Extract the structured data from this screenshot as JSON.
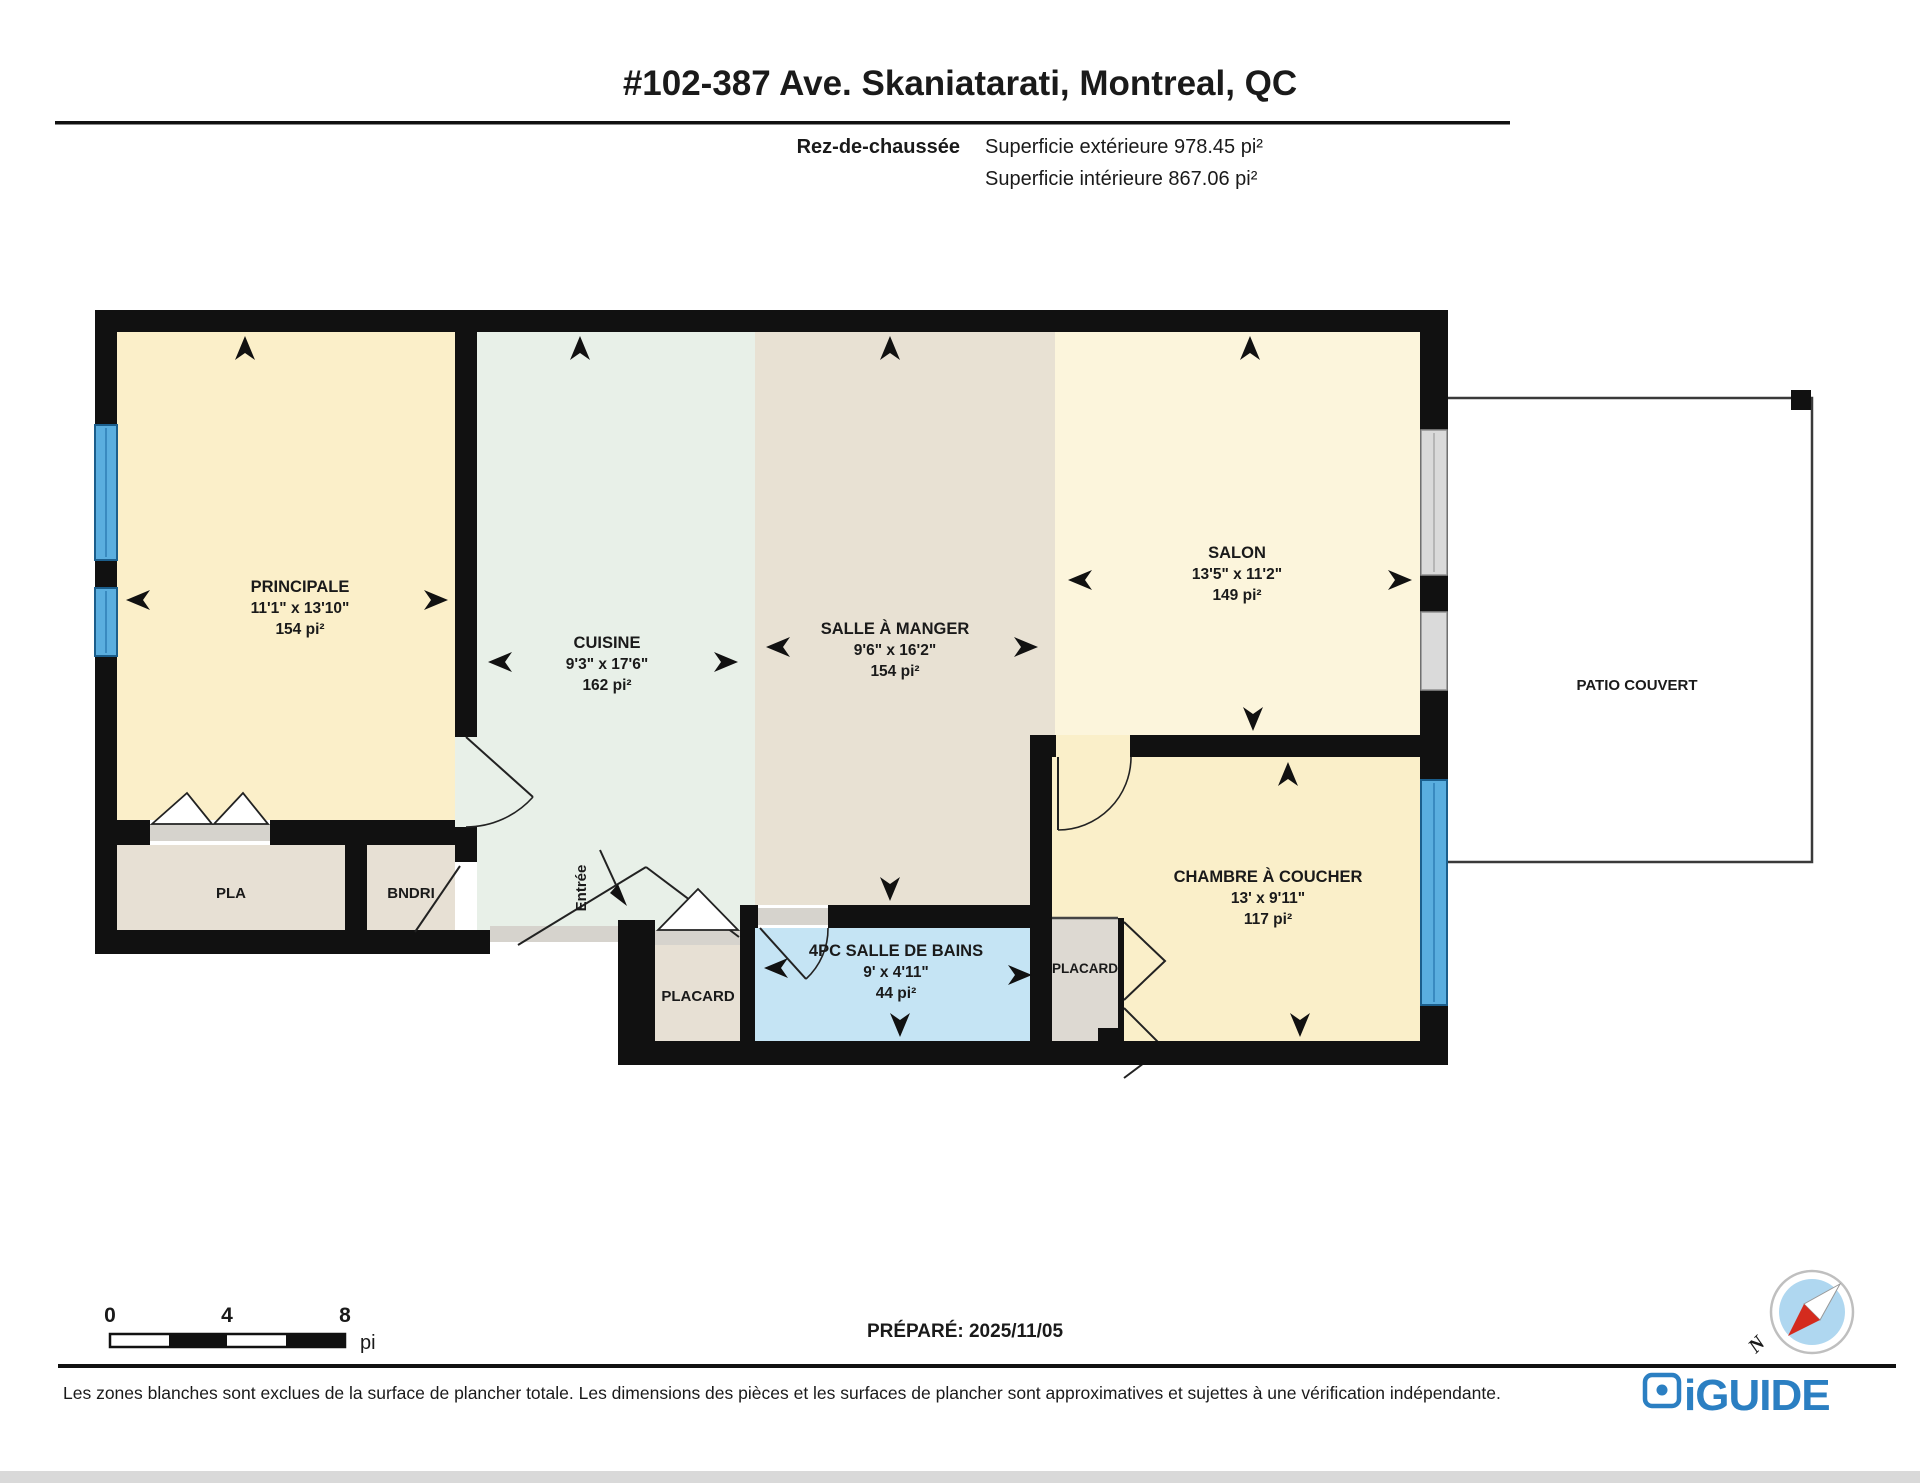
{
  "header": {
    "title": "#102-387 Ave. Skaniatarati, Montreal, QC",
    "floor_label": "Rez-de-chaussée",
    "exterior_area": "Superficie extérieure 978.45 pi²",
    "interior_area": "Superficie intérieure 867.06 pi²"
  },
  "rooms": {
    "principale": {
      "name": "PRINCIPALE",
      "dims": "11'1\" x 13'10\"",
      "area": "154 pi²"
    },
    "cuisine": {
      "name": "CUISINE",
      "dims": "9'3\" x 17'6\"",
      "area": "162 pi²"
    },
    "salle_a_manger": {
      "name": "SALLE À MANGER",
      "dims": "9'6\" x 16'2\"",
      "area": "154 pi²"
    },
    "salon": {
      "name": "SALON",
      "dims": "13'5\" x 11'2\"",
      "area": "149 pi²"
    },
    "chambre": {
      "name": "CHAMBRE À COUCHER",
      "dims": "13' x 9'11\"",
      "area": "117 pi²"
    },
    "salle_de_bains": {
      "name": "4PC SALLE DE BAINS",
      "dims": "9' x 4'11\"",
      "area": "44 pi²"
    },
    "pla": {
      "name": "PLA"
    },
    "bndri": {
      "name": "BNDRI"
    },
    "placard_1": {
      "name": "PLACARD"
    },
    "placard_2": {
      "name": "PLACARD"
    },
    "patio": {
      "name": "PATIO COUVERT"
    },
    "entree": {
      "name": "Entrée"
    }
  },
  "scale_bar": {
    "t0": "0",
    "t4": "4",
    "t8": "8",
    "unit": "pi"
  },
  "footer": {
    "prepared": "PRÉPARÉ: 2025/11/05",
    "disclaimer": "Les zones blanches sont exclues de la surface de plancher totale. Les dimensions des pièces et les surfaces de plancher sont approximatives et sujettes à une vérification indépendante.",
    "brand": "iGUIDE"
  },
  "compass": {
    "north": "N"
  },
  "colors": {
    "principale": "#FBEFC9",
    "salon": "#FCF5DC",
    "chambre": "#FAEFC9",
    "cuisine": "#E8F0E8",
    "salle_a_manger": "#E8E1D3",
    "salle_de_bains": "#C5E4F4",
    "closet": "#E7E0D4",
    "placard_2": "#DDD9D2",
    "wall": "#111111",
    "window_blue": "#5AAEDF",
    "window_gray": "#DADADA",
    "brand_blue": "#2B7FC2",
    "compass_red": "#D42B1E"
  }
}
